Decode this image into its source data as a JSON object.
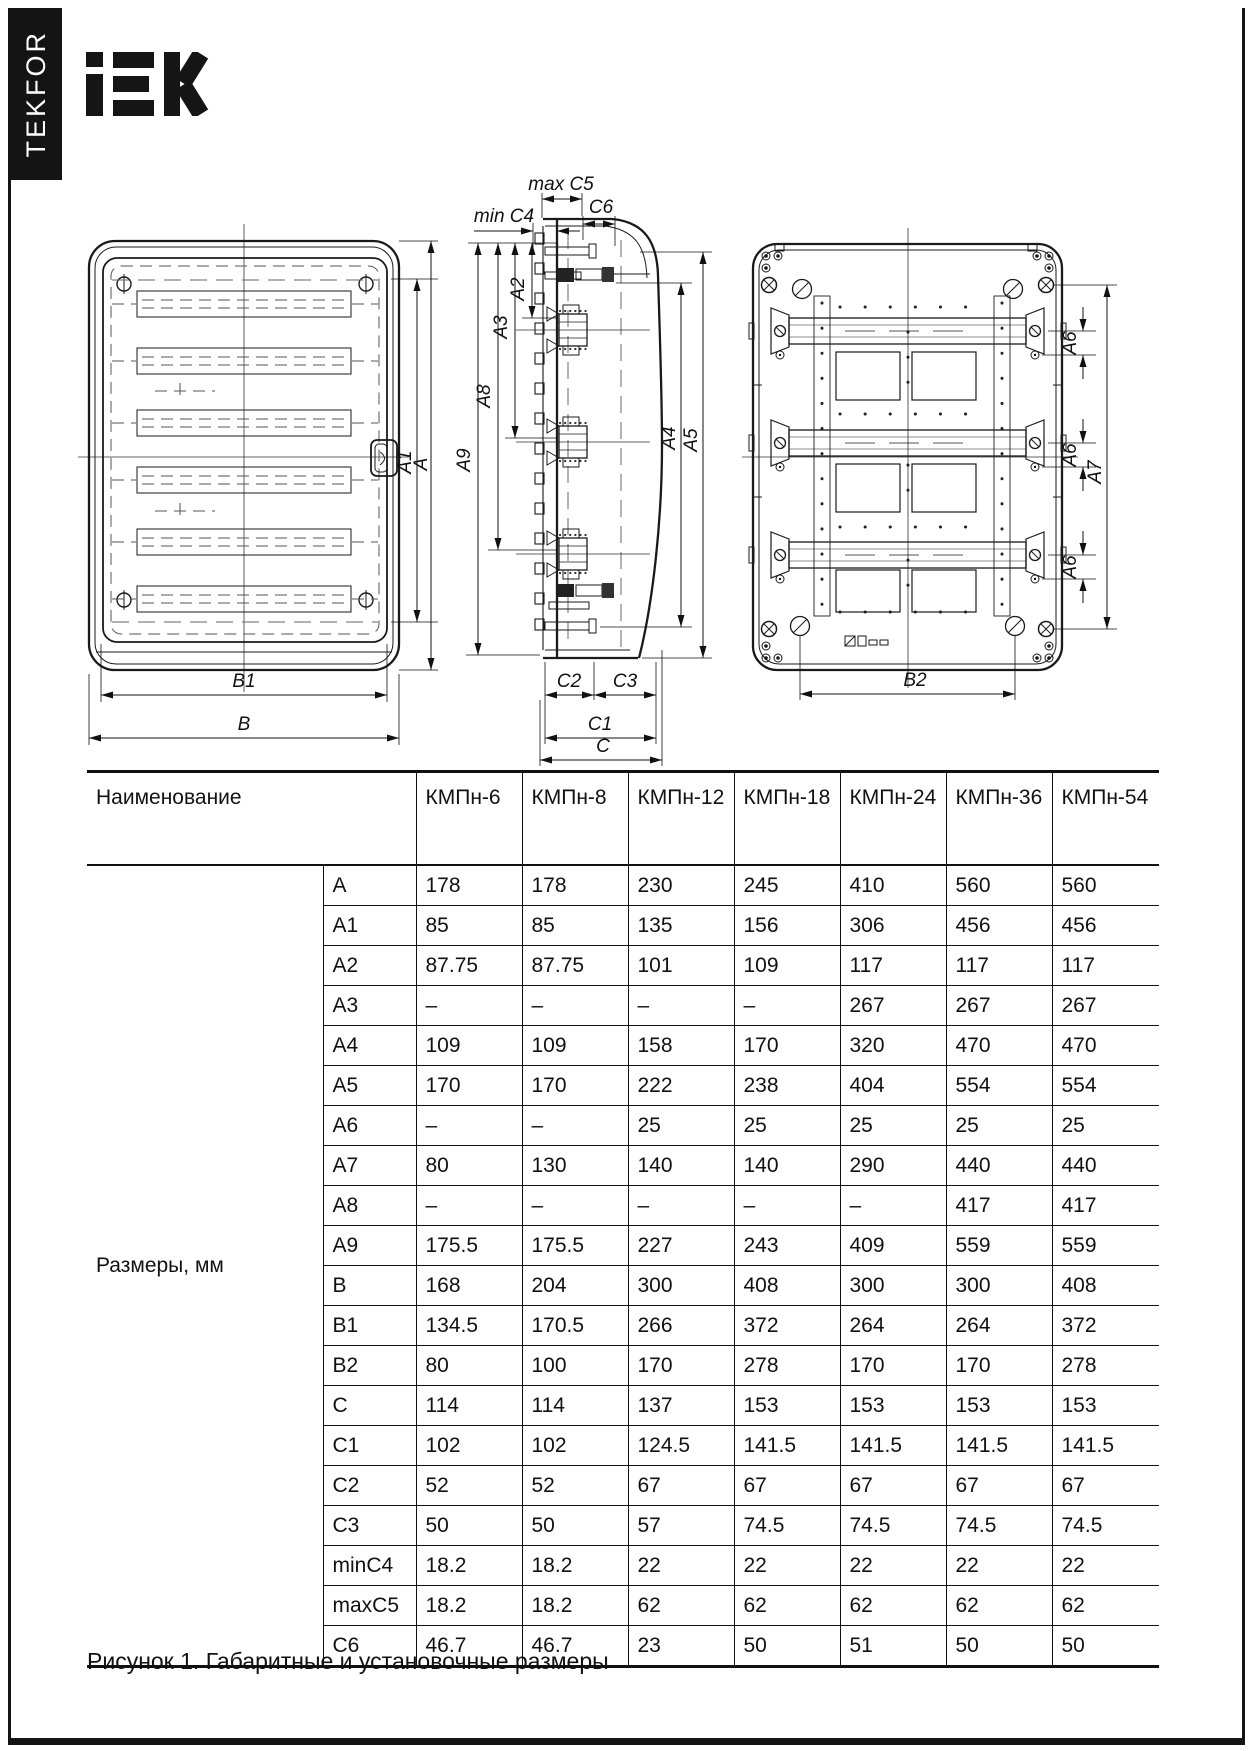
{
  "page": {
    "brand_vertical": "TEKFOR",
    "logo_text": "IEK",
    "caption": "Рисунок 1. Габаритные и установочные размеры"
  },
  "drawings": {
    "front": {
      "a1": "A1",
      "a": "A",
      "b1": "B1",
      "b": "B"
    },
    "side": {
      "max_c5": "max C5",
      "c6": "C6",
      "min_c4": "min C4",
      "a2": "A2",
      "a3": "A3",
      "a8": "A8",
      "a9": "A9",
      "a4": "A4",
      "a5": "A5",
      "c2": "C2",
      "c3": "C3",
      "c1": "C1",
      "c": "C"
    },
    "back": {
      "a6_1": "A6",
      "a6_2": "A6",
      "a6_3": "A6",
      "a7": "A7",
      "b2": "B2"
    }
  },
  "table": {
    "header": {
      "name_label": "Наименование",
      "models": [
        "КМПн-6",
        "КМПн-8",
        "КМПн-12",
        "КМПн-18",
        "КМПн-24",
        "КМПн-36",
        "КМПн-54"
      ]
    },
    "group_label": "Размеры, мм",
    "rows": [
      {
        "dim": "A",
        "values": [
          "178",
          "178",
          "230",
          "245",
          "410",
          "560",
          "560"
        ]
      },
      {
        "dim": "A1",
        "values": [
          "85",
          "85",
          "135",
          "156",
          "306",
          "456",
          "456"
        ]
      },
      {
        "dim": "A2",
        "values": [
          "87.75",
          "87.75",
          "101",
          "109",
          "117",
          "117",
          "117"
        ]
      },
      {
        "dim": "A3",
        "values": [
          "–",
          "–",
          "–",
          "–",
          "267",
          "267",
          "267"
        ]
      },
      {
        "dim": "A4",
        "values": [
          "109",
          "109",
          "158",
          "170",
          "320",
          "470",
          "470"
        ]
      },
      {
        "dim": "A5",
        "values": [
          "170",
          "170",
          "222",
          "238",
          "404",
          "554",
          "554"
        ]
      },
      {
        "dim": "A6",
        "values": [
          "–",
          "–",
          "25",
          "25",
          "25",
          "25",
          "25"
        ]
      },
      {
        "dim": "A7",
        "values": [
          "80",
          "130",
          "140",
          "140",
          "290",
          "440",
          "440"
        ]
      },
      {
        "dim": "A8",
        "values": [
          "–",
          "–",
          "–",
          "–",
          "–",
          "417",
          "417"
        ]
      },
      {
        "dim": "A9",
        "values": [
          "175.5",
          "175.5",
          "227",
          "243",
          "409",
          "559",
          "559"
        ]
      },
      {
        "dim": "B",
        "values": [
          "168",
          "204",
          "300",
          "408",
          "300",
          "300",
          "408"
        ]
      },
      {
        "dim": "B1",
        "values": [
          "134.5",
          "170.5",
          "266",
          "372",
          "264",
          "264",
          "372"
        ]
      },
      {
        "dim": "B2",
        "values": [
          "80",
          "100",
          "170",
          "278",
          "170",
          "170",
          "278"
        ]
      },
      {
        "dim": "C",
        "values": [
          "114",
          "114",
          "137",
          "153",
          "153",
          "153",
          "153"
        ]
      },
      {
        "dim": "C1",
        "values": [
          "102",
          "102",
          "124.5",
          "141.5",
          "141.5",
          "141.5",
          "141.5"
        ]
      },
      {
        "dim": "C2",
        "values": [
          "52",
          "52",
          "67",
          "67",
          "67",
          "67",
          "67"
        ]
      },
      {
        "dim": "C3",
        "values": [
          "50",
          "50",
          "57",
          "74.5",
          "74.5",
          "74.5",
          "74.5"
        ]
      },
      {
        "dim": "minC4",
        "values": [
          "18.2",
          "18.2",
          "22",
          "22",
          "22",
          "22",
          "22"
        ]
      },
      {
        "dim": "maxC5",
        "values": [
          "18.2",
          "18.2",
          "62",
          "62",
          "62",
          "62",
          "62"
        ]
      },
      {
        "dim": "C6",
        "values": [
          "46.7",
          "46.7",
          "23",
          "50",
          "51",
          "50",
          "50"
        ]
      }
    ]
  }
}
